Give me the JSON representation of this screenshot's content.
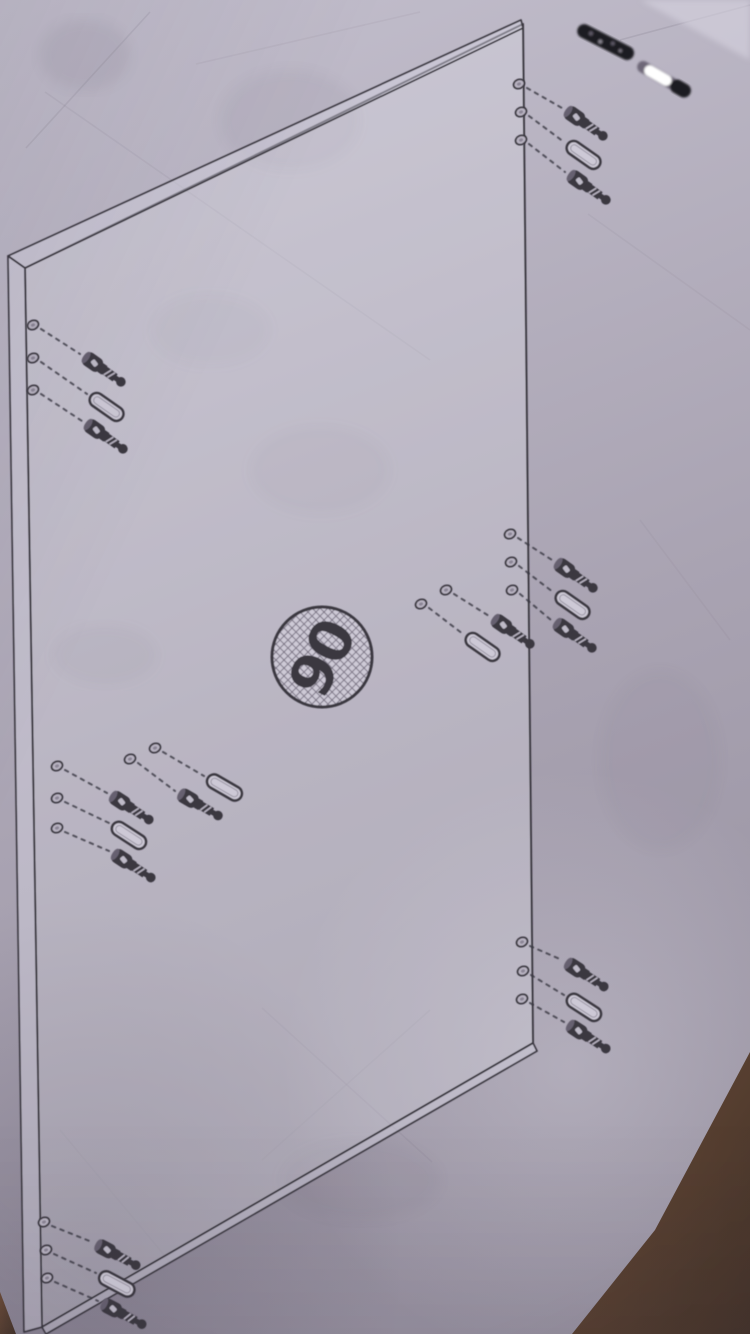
{
  "label": {
    "text": "90"
  },
  "colors": {
    "paper_top": "#c4c0ce",
    "paper_mid": "#a9a3b2",
    "paper_bottom": "#938d9c",
    "paper_hi": "#d9d6e2",
    "ink": "#3a3741",
    "crease": "#6e6878",
    "dowel_fill": "#cdc9d6",
    "hole_fill": "#b9b4c2",
    "cardboard_light": "#6d4c36",
    "cardboard_dark": "#433228",
    "metal_dark": "#1d1b22",
    "metal_glint": "#ffffff"
  },
  "badge": {
    "cx": 322,
    "cy": 657,
    "r": 50,
    "rotation": -63,
    "font_size": 58
  },
  "panel": {
    "parts": [
      {
        "name": "panel-face",
        "points": "25,268 523,24 533,1043 42,1327",
        "fill": "rgba(233,231,240,0.26)",
        "sw": 2
      },
      {
        "name": "panel-top-edge",
        "points": "8,256 521,20 523,28 25,268",
        "fill": "rgba(216,213,226,0.45)",
        "sw": 1.7
      },
      {
        "name": "panel-left-edge",
        "points": "8,256 25,268 42,1327 24,1332",
        "fill": "rgba(216,213,226,0.45)",
        "sw": 1.7
      },
      {
        "name": "panel-bottom-edge",
        "points": "42,1327 533,1043 537,1051 46,1334",
        "fill": "rgba(216,213,226,0.45)",
        "sw": 1.7
      }
    ]
  },
  "groups": [
    {
      "name": "top-right",
      "angle": 35,
      "holes": [
        [
          519,
          84
        ],
        [
          521,
          112
        ],
        [
          521,
          140
        ]
      ],
      "fasteners": [
        {
          "t": "screw",
          "x": 566,
          "y": 110
        },
        {
          "t": "dowel",
          "x": 568,
          "y": 144
        },
        {
          "t": "screw",
          "x": 569,
          "y": 174
        }
      ],
      "dashes": [
        [
          527,
          88,
          562,
          108
        ],
        [
          529,
          116,
          564,
          142
        ],
        [
          529,
          144,
          565,
          172
        ]
      ]
    },
    {
      "name": "upper-left",
      "angle": 35,
      "holes": [
        [
          33,
          325
        ],
        [
          33,
          358
        ],
        [
          33,
          390
        ]
      ],
      "fasteners": [
        {
          "t": "screw",
          "x": 84,
          "y": 356
        },
        {
          "t": "dowel",
          "x": 91,
          "y": 396
        },
        {
          "t": "screw",
          "x": 86,
          "y": 423
        }
      ],
      "dashes": [
        [
          41,
          329,
          80,
          354
        ],
        [
          41,
          362,
          87,
          394
        ],
        [
          41,
          394,
          82,
          421
        ]
      ]
    },
    {
      "name": "middle-right-edge",
      "angle": 35,
      "holes": [
        [
          510,
          534
        ],
        [
          511,
          562
        ],
        [
          512,
          590
        ]
      ],
      "fasteners": [
        {
          "t": "screw",
          "x": 556,
          "y": 562
        },
        {
          "t": "dowel",
          "x": 557,
          "y": 594
        },
        {
          "t": "screw",
          "x": 555,
          "y": 622
        }
      ],
      "dashes": [
        [
          518,
          538,
          552,
          560
        ],
        [
          519,
          566,
          553,
          592
        ],
        [
          520,
          594,
          551,
          620
        ]
      ]
    },
    {
      "name": "middle-inner",
      "angle": 35,
      "holes": [
        [
          446,
          590
        ],
        [
          421,
          604
        ]
      ],
      "fasteners": [
        {
          "t": "screw",
          "x": 493,
          "y": 618
        },
        {
          "t": "dowel",
          "x": 467,
          "y": 636
        }
      ],
      "dashes": [
        [
          454,
          594,
          489,
          616
        ],
        [
          429,
          608,
          463,
          634
        ]
      ]
    },
    {
      "name": "lower-left",
      "angle": 33,
      "holes": [
        [
          57,
          766
        ],
        [
          57,
          798
        ],
        [
          57,
          828
        ]
      ],
      "fasteners": [
        {
          "t": "screw",
          "x": 111,
          "y": 795
        },
        {
          "t": "dowel",
          "x": 113,
          "y": 825
        },
        {
          "t": "screw",
          "x": 113,
          "y": 853
        }
      ],
      "dashes": [
        [
          65,
          770,
          107,
          793
        ],
        [
          65,
          802,
          109,
          823
        ],
        [
          65,
          832,
          109,
          851
        ]
      ]
    },
    {
      "name": "lower-inner",
      "angle": 30,
      "holes": [
        [
          130,
          759
        ],
        [
          155,
          748
        ]
      ],
      "fasteners": [
        {
          "t": "dowel",
          "x": 208,
          "y": 778
        },
        {
          "t": "screw",
          "x": 179,
          "y": 793
        }
      ],
      "dashes": [
        [
          163,
          752,
          204,
          776
        ],
        [
          138,
          763,
          175,
          791
        ]
      ]
    },
    {
      "name": "bottom-right",
      "angle": 33,
      "holes": [
        [
          522,
          942
        ],
        [
          523,
          971
        ],
        [
          522,
          999
        ]
      ],
      "fasteners": [
        {
          "t": "screw",
          "x": 566,
          "y": 962
        },
        {
          "t": "dowel",
          "x": 568,
          "y": 997
        },
        {
          "t": "screw",
          "x": 568,
          "y": 1024
        }
      ],
      "dashes": [
        [
          530,
          946,
          562,
          960
        ],
        [
          531,
          975,
          564,
          995
        ],
        [
          530,
          1003,
          564,
          1022
        ]
      ]
    },
    {
      "name": "bottom-left",
      "angle": 28,
      "holes": [
        [
          44,
          1222
        ],
        [
          46,
          1250
        ],
        [
          47,
          1278
        ]
      ],
      "fasteners": [
        {
          "t": "screw",
          "x": 96,
          "y": 1244
        },
        {
          "t": "dowel",
          "x": 100,
          "y": 1275
        },
        {
          "t": "screw",
          "x": 102,
          "y": 1303
        }
      ],
      "dashes": [
        [
          52,
          1226,
          92,
          1242
        ],
        [
          54,
          1254,
          96,
          1273
        ],
        [
          55,
          1282,
          98,
          1301
        ]
      ]
    }
  ],
  "creases": {
    "lines": [
      [
        45,
        92,
        430,
        360,
        0.09
      ],
      [
        26,
        148,
        150,
        12,
        0.14
      ],
      [
        196,
        64,
        420,
        12,
        0.08
      ],
      [
        588,
        214,
        750,
        330,
        0.08
      ],
      [
        262,
        1008,
        432,
        1162,
        0.11
      ],
      [
        430,
        1010,
        262,
        1160,
        0.09
      ],
      [
        60,
        1130,
        170,
        1262,
        0.09
      ],
      [
        620,
        40,
        750,
        5,
        0.18
      ],
      [
        640,
        520,
        730,
        640,
        0.07
      ]
    ],
    "blotches": [
      [
        85,
        55,
        45,
        35,
        0.1
      ],
      [
        105,
        655,
        52,
        30,
        0.09
      ],
      [
        320,
        470,
        70,
        44,
        0.07
      ],
      [
        210,
        330,
        60,
        36,
        0.06
      ],
      [
        360,
        1180,
        80,
        40,
        0.07
      ],
      [
        660,
        760,
        60,
        90,
        0.05
      ],
      [
        290,
        120,
        70,
        50,
        0.07
      ]
    ]
  },
  "photo": {
    "cardboard": [
      "750,1052 655,1230 572,1334 750,1334",
      "0,1292 16,1334 0,1334"
    ],
    "corner_highlight": "640,0 750,0 750,60",
    "metal_parts": [
      {
        "t": "metal-dark",
        "x": 578,
        "y": 28,
        "a": 27
      },
      {
        "t": "metal-shiny",
        "x": 638,
        "y": 64,
        "a": 30
      }
    ]
  }
}
